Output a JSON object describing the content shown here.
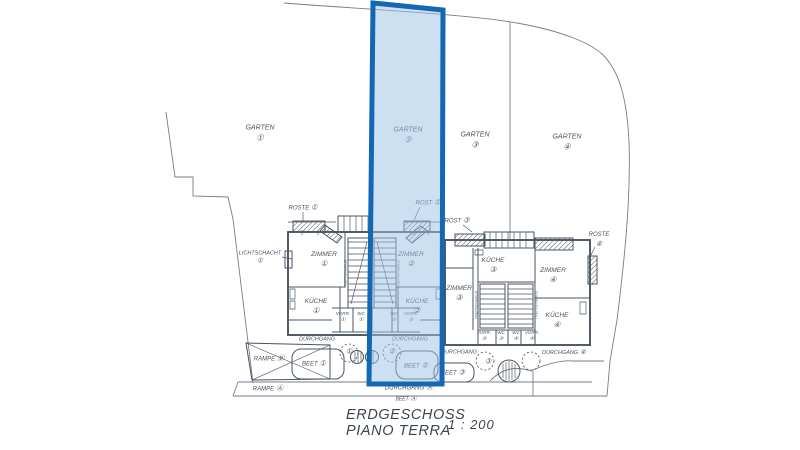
{
  "colors": {
    "ink": "#4a545f",
    "line": "#767e89",
    "highlight_border": "#1467b3",
    "highlight_fill": "#9cc2e5"
  },
  "title_block": {
    "line1": "ERDGESCHOSS",
    "line2": "PIANO TERRA",
    "scale": "1 : 200"
  },
  "labels": [
    {
      "text": "GARTEN",
      "num": "①"
    },
    {
      "text": "GARTEN",
      "num": "②"
    },
    {
      "text": "GARTEN",
      "num": "③"
    },
    {
      "text": "GARTEN",
      "num": "④"
    },
    {
      "text": "ROSTE",
      "num": "①"
    },
    {
      "text": "ROST",
      "num": "②"
    },
    {
      "text": "ROST",
      "num": "③"
    },
    {
      "text": "ROSTE",
      "num": "④"
    },
    {
      "text": "LICHTSCHACHT",
      "num": "①"
    },
    {
      "text": "ZIMMER",
      "num": "①"
    },
    {
      "text": "ZIMMER",
      "num": "②"
    },
    {
      "text": "KÜCHE",
      "num": "①"
    },
    {
      "text": "KÜCHE",
      "num": "②"
    },
    {
      "text": "KÜCHE",
      "num": "③"
    },
    {
      "text": "ZIMMER",
      "num": "③"
    },
    {
      "text": "ZIMMER",
      "num": "④"
    },
    {
      "text": "KÜCHE",
      "num": "④"
    },
    {
      "text": "VORR.",
      "num": "①"
    },
    {
      "text": "WC",
      "num": "①"
    },
    {
      "text": "WC",
      "num": "②"
    },
    {
      "text": "VORR.",
      "num": "②"
    },
    {
      "text": "VORR.",
      "num": "③"
    },
    {
      "text": "WC",
      "num": "③"
    },
    {
      "text": "WC",
      "num": "④"
    },
    {
      "text": "VORR.",
      "num": "④"
    },
    {
      "text": "DURCHGANG"
    },
    {
      "num": "①"
    },
    {
      "text": "DURCHGANG"
    },
    {
      "num": "②"
    },
    {
      "text": "DURCHGANG"
    },
    {
      "num": "③"
    },
    {
      "text": "DURCHGANG",
      "num": "④"
    },
    {
      "text": "BEET",
      "num": "①"
    },
    {
      "text": "BEET",
      "num": "②"
    },
    {
      "text": "BEET",
      "num": "③"
    },
    {
      "text": "RAMPE",
      "num": "Ⓑ"
    },
    {
      "text": "RAMPE",
      "num": "Ⓐ"
    },
    {
      "text": "DURCHGANG",
      "num": "Ⓐ"
    },
    {
      "text": "BEET",
      "num": "Ⓐ"
    },
    {
      "text": "TREPPENHAUS"
    },
    {
      "text": "TREPPENHAUS"
    },
    {
      "text": "TREPPENHAUS"
    },
    {
      "text": "TREPPENHAUS"
    }
  ]
}
